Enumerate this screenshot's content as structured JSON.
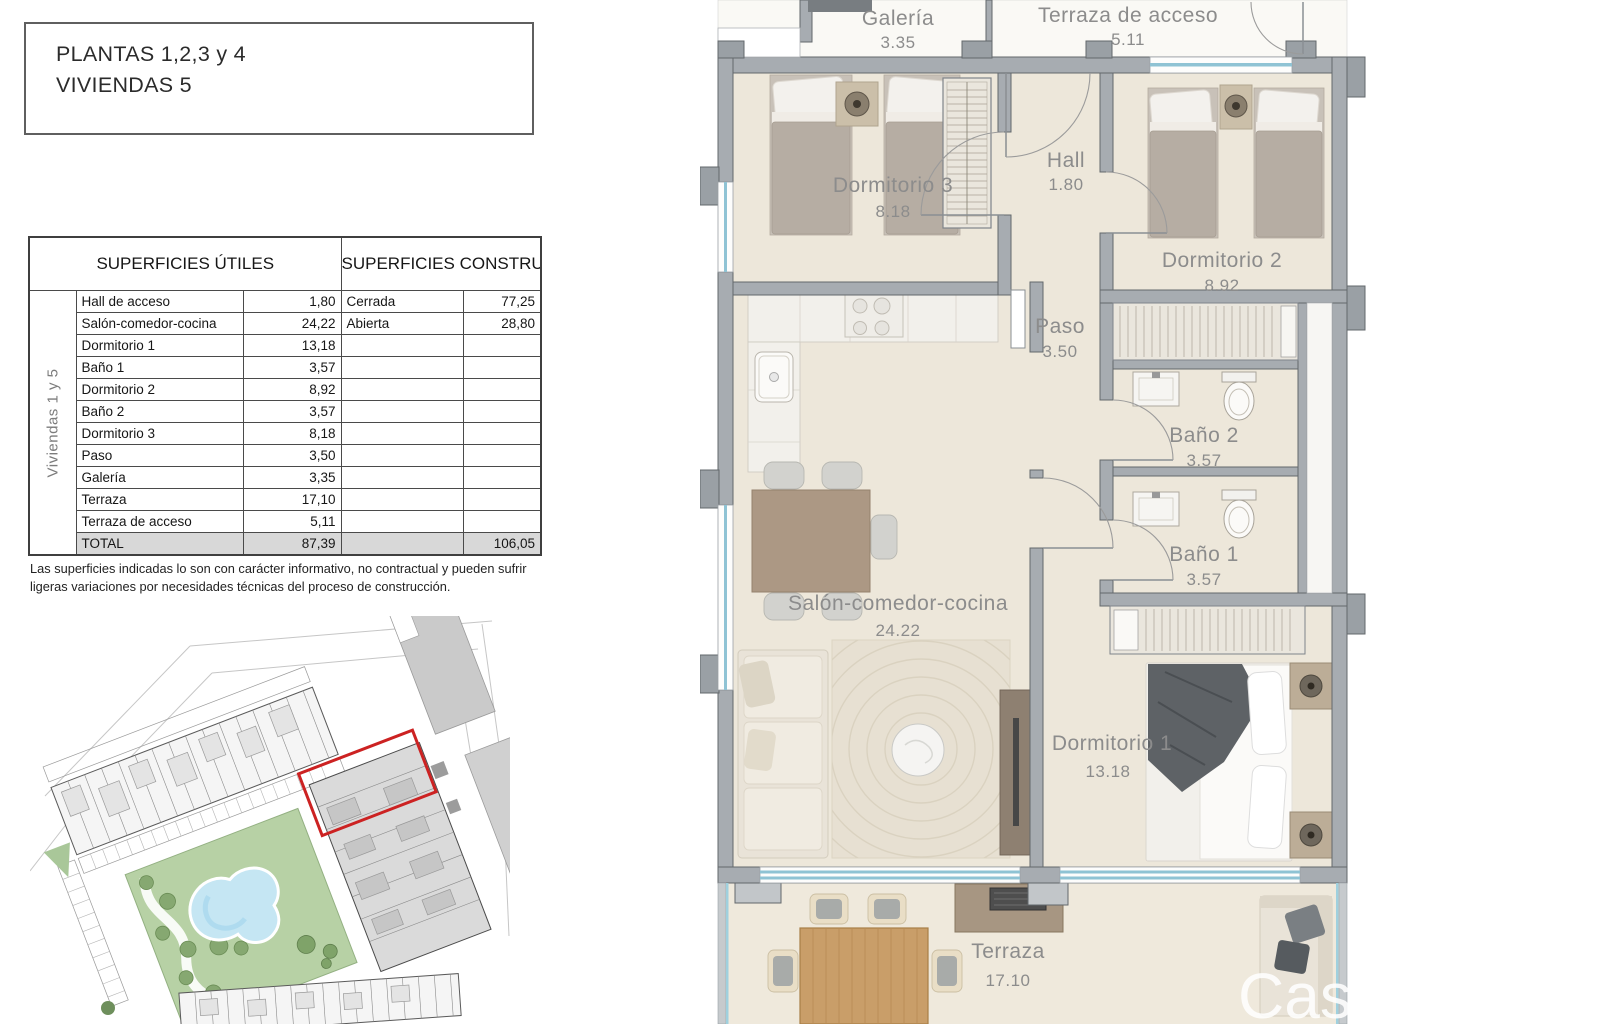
{
  "title": {
    "line1": "PLANTAS 1,2,3 y 4",
    "line2": "VIVIENDAS 5"
  },
  "table": {
    "header_utiles": "SUPERFICIES ÚTILES",
    "header_construidas": "SUPERFICIES CONSTRUIDAS",
    "side_label": "Viviendas 1 y 5",
    "rows": [
      {
        "name": "Hall de acceso",
        "value": "1,80",
        "cname": "Cerrada",
        "cvalue": "77,25"
      },
      {
        "name": "Salón-comedor-cocina",
        "value": "24,22",
        "cname": "Abierta",
        "cvalue": "28,80"
      },
      {
        "name": "Dormitorio 1",
        "value": "13,18",
        "cname": "",
        "cvalue": ""
      },
      {
        "name": "Baño 1",
        "value": "3,57",
        "cname": "",
        "cvalue": ""
      },
      {
        "name": "Dormitorio 2",
        "value": "8,92",
        "cname": "",
        "cvalue": ""
      },
      {
        "name": "Baño 2",
        "value": "3,57",
        "cname": "",
        "cvalue": ""
      },
      {
        "name": "Dormitorio 3",
        "value": "8,18",
        "cname": "",
        "cvalue": ""
      },
      {
        "name": "Paso",
        "value": "3,50",
        "cname": "",
        "cvalue": ""
      },
      {
        "name": "Galería",
        "value": "3,35",
        "cname": "",
        "cvalue": ""
      },
      {
        "name": "Terraza",
        "value": "17,10",
        "cname": "",
        "cvalue": ""
      },
      {
        "name": "Terraza de acceso",
        "value": "5,11",
        "cname": "",
        "cvalue": ""
      }
    ],
    "total": {
      "name": "TOTAL",
      "value": "87,39",
      "cvalue": "106,05"
    }
  },
  "disclaimer": "Las superficies indicadas lo son con carácter informativo, no contractual y pueden sufrir ligeras variaciones por necesidades técnicas del proceso de construcción.",
  "floorplan": {
    "rooms": {
      "galeria": {
        "label": "Galería",
        "value": "3.35"
      },
      "terraza_acceso": {
        "label": "Terraza de acceso",
        "value": "5.11"
      },
      "dormitorio3": {
        "label": "Dormitorio 3",
        "value": "8.18"
      },
      "hall": {
        "label": "Hall",
        "value": "1.80"
      },
      "dormitorio2": {
        "label": "Dormitorio 2",
        "value": "8.92"
      },
      "paso": {
        "label": "Paso",
        "value": "3.50"
      },
      "bano2": {
        "label": "Baño 2",
        "value": "3.57"
      },
      "bano1": {
        "label": "Baño 1",
        "value": "3.57"
      },
      "salon": {
        "label": "Salón-comedor-cocina",
        "value": "24.22"
      },
      "dormitorio1": {
        "label": "Dormitorio 1",
        "value": "13.18"
      },
      "terraza": {
        "label": "Terraza",
        "value": "17.10"
      }
    },
    "watermark": "Cas"
  },
  "colors": {
    "floor": "#EDE7DA",
    "wall": "#A7ACB1",
    "window_blue": "#8FC3D4",
    "label_gray": "#8C8C8C",
    "highlight_red": "#CC2222",
    "total_row_bg": "#D8D8D8"
  }
}
